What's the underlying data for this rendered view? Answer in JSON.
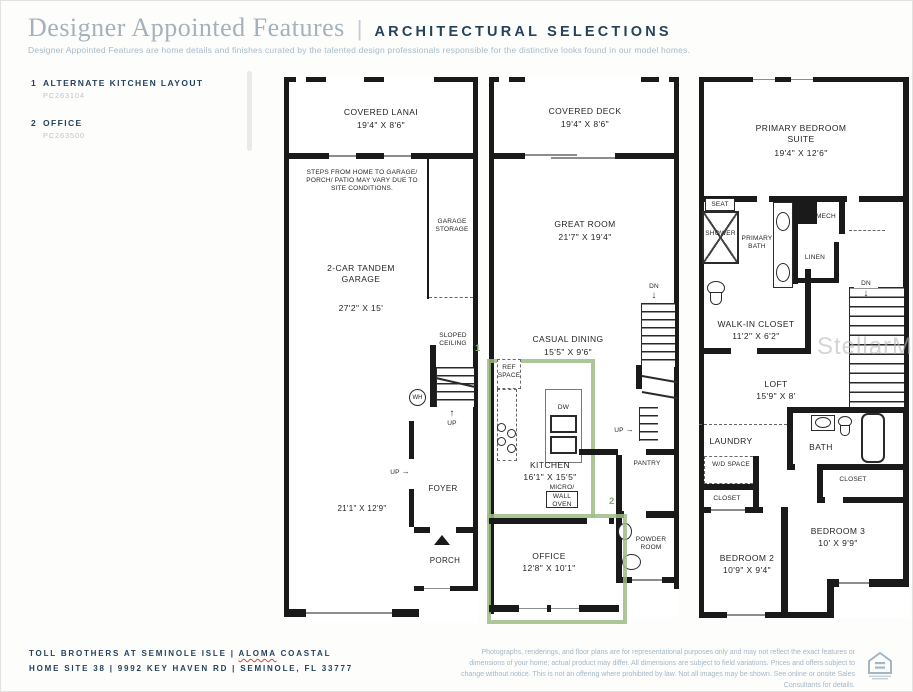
{
  "header": {
    "title": "Designer Appointed Features",
    "divider": "|",
    "subtitle_caps": "ARCHITECTURAL SELECTIONS",
    "description": "Designer Appointed Features are home details and finishes curated by the talented design professionals responsible for the distinctive looks found in our model homes."
  },
  "options": [
    {
      "num": "1",
      "label": "ALTERNATE KITCHEN LAYOUT",
      "code": "PC263104"
    },
    {
      "num": "2",
      "label": "OFFICE",
      "code": "PC263500"
    }
  ],
  "floor1": {
    "covered_lanai": "COVERED LANAI",
    "covered_lanai_dim": "19'4\" X 8'6\"",
    "steps_note": "STEPS FROM HOME TO GARAGE/ PORCH/ PATIO MAY VARY DUE TO SITE CONDITIONS.",
    "garage_storage": "GARAGE STORAGE",
    "garage": "2-CAR TANDEM GARAGE",
    "garage_dim": "27'2\" X 15'",
    "sloped_ceiling": "SLOPED CEILING",
    "wh": "WH",
    "up": "UP",
    "foyer": "FOYER",
    "foyer_dim": "21'1\" X 12'9\"",
    "porch": "PORCH"
  },
  "floor2": {
    "covered_deck": "COVERED DECK",
    "covered_deck_dim": "19'4\" X 8'6\"",
    "great_room": "GREAT ROOM",
    "great_room_dim": "21'7\" X 19'4\"",
    "casual_dining": "CASUAL DINING",
    "casual_dining_dim": "15'5\" X 9'6\"",
    "dn": "DN",
    "up": "UP",
    "ref_space": "REF SPACE",
    "dw": "DW",
    "kitchen": "KITCHEN",
    "kitchen_dim": "16'1\" X 15'5\"",
    "micro": "MICRO/",
    "wall_oven": "WALL OVEN",
    "pantry": "PANTRY",
    "powder_room": "POWDER ROOM",
    "office": "OFFICE",
    "office_dim": "12'8\" X 10'1\"",
    "marker_kitchen": "1",
    "marker_office": "2"
  },
  "floor3": {
    "primary_suite": "PRIMARY BEDROOM SUITE",
    "primary_suite_dim": "19'4\" X 12'6\"",
    "seat": "SEAT",
    "shower": "SHOWER",
    "primary_bath": "PRIMARY BATH",
    "mech": "MECH",
    "linen": "LINEN",
    "walk_in_closet": "WALK-IN CLOSET",
    "walk_in_closet_dim": "11'2\" X 6'2\"",
    "dn": "DN",
    "loft": "LOFT",
    "loft_dim": "15'9\" X 8'",
    "laundry": "LAUNDRY",
    "wd_space": "W/D SPACE",
    "closet_b2": "CLOSET",
    "bath": "BATH",
    "closet_b3": "CLOSET",
    "bedroom2": "BEDROOM 2",
    "bedroom2_dim": "10'9\" X 9'4\"",
    "bedroom3": "BEDROOM 3",
    "bedroom3_dim": "10' X 9'9\""
  },
  "icons": {
    "up_arrow": "↑",
    "down_arrow": "↓",
    "right_arrow": "→"
  },
  "watermark": "StellarMLS",
  "footer": {
    "community": "TOLL BROTHERS AT SEMINOLE ISLE",
    "sep": "|",
    "model": "ALOMA",
    "model_suffix": "COASTAL",
    "address": "HOME SITE 38   |   9992 KEY HAVEN RD   |   SEMINOLE, FL 33777",
    "disclaimer": "Photographs, renderings, and floor plans are for representational purposes only and may not reflect the exact features or dimensions of your home; actual product may differ. All dimensions are subject to field variations. Prices and offers subject to change without notice. This is not an offering where prohibited by law. Not all images may be shown. See online or onsite Sales Consultants for details."
  },
  "colors": {
    "navy": "#25425d",
    "light_blue": "#a3b7c7",
    "green": "#9ebc85",
    "wall": "#1a1a1a"
  }
}
